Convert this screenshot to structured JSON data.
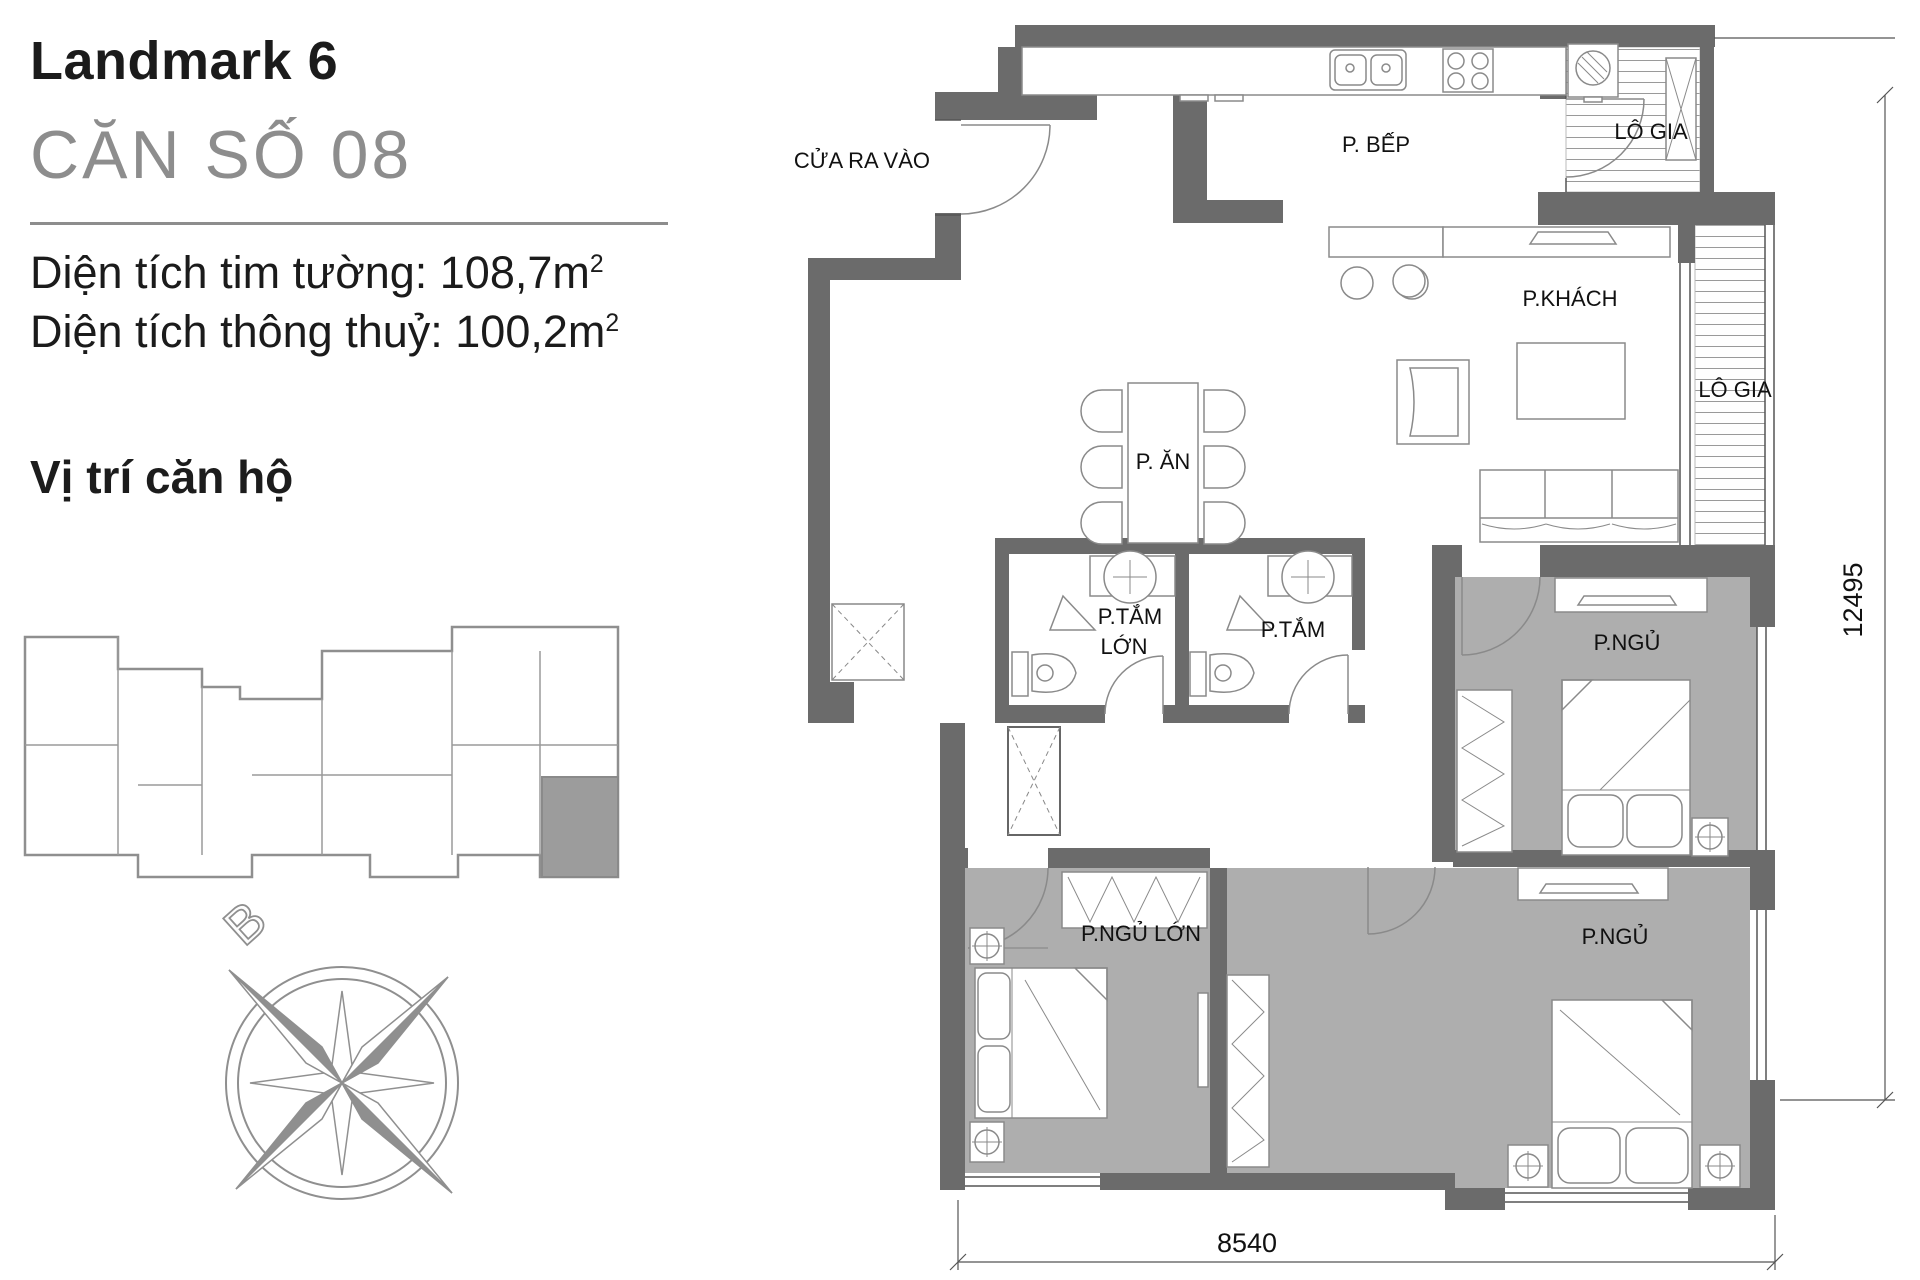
{
  "left_panel": {
    "project": "Landmark 6",
    "unit": "CĂN SỐ 08",
    "area_wall": {
      "text": "Diện tích tim tường: 108,7m",
      "sup": "2"
    },
    "area_clear": {
      "text": "Diện tích thông thuỷ: 100,2m",
      "sup": "2"
    },
    "location_heading": "Vị trí căn hộ",
    "compass_north": "B"
  },
  "plan": {
    "labels": {
      "entrance": "CỬA RA VÀO",
      "kitchen": "P. BẾP",
      "loggia_top": "LÔ GIA",
      "living": "P.KHÁCH",
      "loggia_right": "LÔ GIA",
      "dining": "P. ĂN",
      "bath_large_line1": "P.TẮM",
      "bath_large_line2": "LỚN",
      "bath_small": "P.TẮM",
      "bedroom_top": "P.NGỦ",
      "bedroom_master": "P.NGỦ LỚN",
      "bedroom_bottom": "P.NGỦ"
    },
    "dimensions": {
      "width": "8540",
      "height": "12495"
    }
  },
  "colors": {
    "wall": "#6b6b6b",
    "room_floor_gray": "#aeaeae",
    "highlight_unit": "#9c9c9c",
    "accent_text_gray": "#8d8d8d"
  }
}
